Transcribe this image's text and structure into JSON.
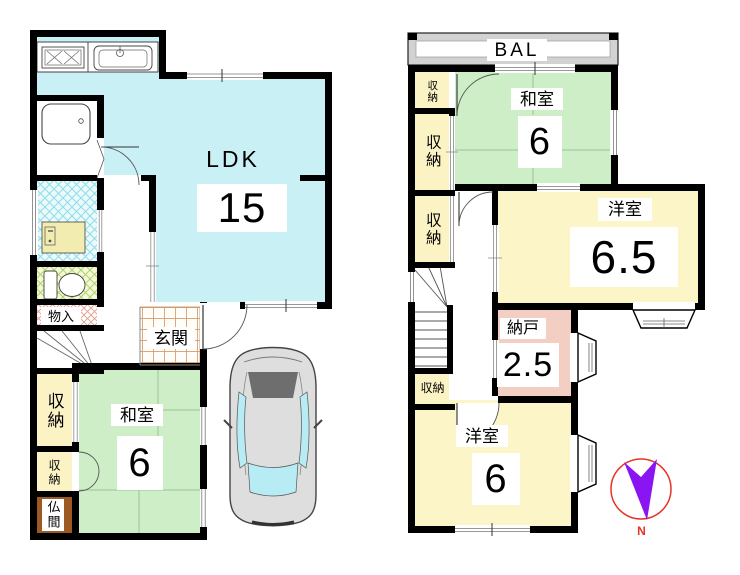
{
  "floor1": {
    "ldk": {
      "name": "LDK",
      "area": "15"
    },
    "washitsu": {
      "name": "和室",
      "area": "6"
    },
    "genkan": {
      "name": "玄関"
    },
    "monoire": {
      "name": "物入"
    },
    "butsuma": {
      "name": "仏間"
    },
    "closet_main": {
      "name": "収納"
    },
    "closet_sub": {
      "name": "収納"
    }
  },
  "floor2": {
    "balcony": {
      "name": "BAL"
    },
    "washitsu": {
      "name": "和室",
      "area": "6"
    },
    "yoshitsu_large": {
      "name": "洋室",
      "area": "6.5"
    },
    "nando": {
      "name": "納戸",
      "area": "2.5"
    },
    "yoshitsu_small": {
      "name": "洋室",
      "area": "6"
    },
    "closet_top": {
      "name": "収納"
    },
    "closet_upper": {
      "name": "収納"
    },
    "closet_mid": {
      "name": "収納"
    },
    "closet_stairs": {
      "name": "収納"
    }
  },
  "compass": {
    "north_label": "N"
  },
  "colors": {
    "ldk": "#c9f0f4",
    "tatami": "#cdeec6",
    "western": "#fbf5c8",
    "closet": "#fbf3c4",
    "storeroom": "#f2cfc2",
    "butsuma": "#9c5a22",
    "balcony": "#d2d2d2",
    "wall": "#000000",
    "compass_ring": "#e63329",
    "compass_arrow": "#8a15f2",
    "car_window": "#b8ecf4"
  }
}
